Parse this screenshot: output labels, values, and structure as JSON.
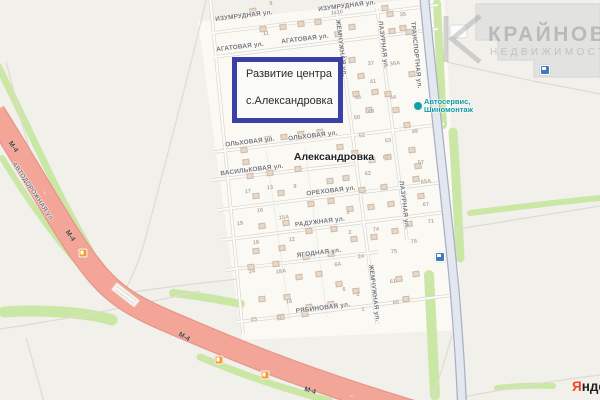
{
  "map": {
    "colors": {
      "base": "#F2F0EB",
      "village_fill": "#FAF9F4",
      "highway": "#F3A697",
      "highway_casing": "#E6968A",
      "vegetation": "#CBE7A5",
      "road_blue_fill": "#E3E7EF",
      "road_blue_casing": "#A7B1C4",
      "annotation_border": "#3B3FA6",
      "poi_teal": "#0C9CA0",
      "transit_blue": "#4079BE",
      "fuel_orange": "#F49D37",
      "yandex_red": "#FC3F1D"
    },
    "place_label": {
      "text": "Александровка",
      "x": 334,
      "y": 157
    },
    "annotation": {
      "line1": "Развитие центра",
      "line2": "с.Александровка"
    },
    "watermark": {
      "title": "КРАЙНОВ",
      "subtitle": "НЕДВИЖИМОСТЬ"
    },
    "yandex": {
      "first": "Я",
      "rest": "ндекс"
    },
    "poi_service": {
      "line1": "Автосервис,",
      "line2": "Шиномонтаж",
      "x": 424,
      "y": 106
    },
    "street_labels": [
      {
        "text": "ИЗУМРУДНАЯ ул.",
        "x": 244,
        "y": 16,
        "rot": -7
      },
      {
        "text": "ИЗУМРУДНАЯ ул.",
        "x": 347,
        "y": 6,
        "rot": -7
      },
      {
        "text": "АГАТОВАЯ ул.",
        "x": 240,
        "y": 47,
        "rot": -7
      },
      {
        "text": "АГАТОВАЯ ул.",
        "x": 305,
        "y": 39,
        "rot": -7
      },
      {
        "text": "ОЛЬХОВАЯ ул.",
        "x": 250,
        "y": 142,
        "rot": -7
      },
      {
        "text": "ОЛЬХОВАЯ ул.",
        "x": 313,
        "y": 136,
        "rot": -7
      },
      {
        "text": "ВАСИЛЬКОВАЯ ул.",
        "x": 252,
        "y": 170,
        "rot": -7
      },
      {
        "text": "ОРЕХОВАЯ ул.",
        "x": 331,
        "y": 191,
        "rot": -7
      },
      {
        "text": "РАДУЖНАЯ ул.",
        "x": 320,
        "y": 222,
        "rot": -7
      },
      {
        "text": "ЯГОДНАЯ ул.",
        "x": 319,
        "y": 253,
        "rot": -7
      },
      {
        "text": "РЯБИНОВАЯ ул.",
        "x": 323,
        "y": 308,
        "rot": -7
      },
      {
        "text": "ЖЕМЧУЖНАЯ ул.",
        "x": 341,
        "y": 48,
        "rot": 83
      },
      {
        "text": "ЖЕМЧУЖНАЯ ул.",
        "x": 374,
        "y": 293,
        "rot": 83
      },
      {
        "text": "ЛАЗУРНАЯ ул.",
        "x": 383,
        "y": 45,
        "rot": 83
      },
      {
        "text": "ЛАЗУРНАЯ ул.",
        "x": 404,
        "y": 205,
        "rot": 83
      },
      {
        "text": "ТРАНСПОРТНАЯ ул.",
        "x": 416,
        "y": 55,
        "rot": 84
      },
      {
        "text": "АВТОДОРОЖНАЯ ул.",
        "x": 33,
        "y": 192,
        "rot": 56
      }
    ],
    "highway_labels": [
      {
        "text": "М-4",
        "x": 13,
        "y": 147,
        "rot": 55
      },
      {
        "text": "М-4",
        "x": 70,
        "y": 236,
        "rot": 55
      },
      {
        "text": "М-4",
        "x": 184,
        "y": 337,
        "rot": 30
      },
      {
        "text": "М-4",
        "x": 310,
        "y": 391,
        "rot": 17
      }
    ],
    "house_numbers": [
      [
        "9",
        271,
        4
      ],
      [
        "1к10",
        337,
        13
      ],
      [
        "11",
        266,
        34
      ],
      [
        "35",
        403,
        15
      ],
      [
        "7",
        346,
        59
      ],
      [
        "37",
        371,
        64
      ],
      [
        "36А",
        395,
        64
      ],
      [
        "41",
        373,
        82
      ],
      [
        "44",
        393,
        98
      ],
      [
        "46",
        358,
        98
      ],
      [
        "49",
        371,
        112
      ],
      [
        "50",
        357,
        118
      ],
      [
        "52",
        362,
        136
      ],
      [
        "53",
        388,
        141
      ],
      [
        "57",
        386,
        158
      ],
      [
        "62",
        368,
        174
      ],
      [
        "49",
        415,
        132
      ],
      [
        "57",
        421,
        163
      ],
      [
        "65А",
        426,
        182
      ],
      [
        "67",
        426,
        205
      ],
      [
        "71",
        431,
        222
      ],
      [
        "76",
        414,
        242
      ],
      [
        "17",
        248,
        192
      ],
      [
        "13",
        270,
        188
      ],
      [
        "9",
        295,
        187
      ],
      [
        "16",
        260,
        211
      ],
      [
        "15А",
        284,
        218
      ],
      [
        "19",
        240,
        224
      ],
      [
        "18",
        256,
        243
      ],
      [
        "12",
        292,
        240
      ],
      [
        "1",
        348,
        213
      ],
      [
        "2",
        350,
        233
      ],
      [
        "74",
        376,
        230
      ],
      [
        "75",
        394,
        252
      ],
      [
        "24",
        361,
        257
      ],
      [
        "6А",
        338,
        265
      ],
      [
        "24",
        252,
        272
      ],
      [
        "18А",
        281,
        272
      ],
      [
        "6",
        344,
        290
      ],
      [
        "2",
        358,
        295
      ],
      [
        "61",
        393,
        282
      ],
      [
        "65",
        396,
        303
      ],
      [
        "18",
        289,
        302
      ],
      [
        "23",
        254,
        320
      ],
      [
        "17",
        279,
        318
      ],
      [
        "1",
        363,
        310
      ]
    ],
    "buildings": [
      [
        253,
        11
      ],
      [
        263,
        29
      ],
      [
        283,
        27
      ],
      [
        301,
        24
      ],
      [
        318,
        22
      ],
      [
        352,
        27
      ],
      [
        390,
        14
      ],
      [
        403,
        28
      ],
      [
        338,
        34
      ],
      [
        244,
        150
      ],
      [
        246,
        162
      ],
      [
        385,
        8
      ],
      [
        392,
        31
      ],
      [
        409,
        32
      ],
      [
        412,
        74
      ],
      [
        352,
        60
      ],
      [
        361,
        76
      ],
      [
        375,
        92
      ],
      [
        356,
        94
      ],
      [
        369,
        110
      ],
      [
        388,
        94
      ],
      [
        396,
        110
      ],
      [
        407,
        125
      ],
      [
        268,
        139
      ],
      [
        284,
        137
      ],
      [
        301,
        134
      ],
      [
        320,
        132
      ],
      [
        340,
        147
      ],
      [
        355,
        153
      ],
      [
        372,
        160
      ],
      [
        388,
        157
      ],
      [
        250,
        176
      ],
      [
        270,
        173
      ],
      [
        298,
        169
      ],
      [
        330,
        181
      ],
      [
        346,
        178
      ],
      [
        362,
        190
      ],
      [
        384,
        187
      ],
      [
        256,
        196
      ],
      [
        281,
        193
      ],
      [
        311,
        204
      ],
      [
        331,
        201
      ],
      [
        350,
        209
      ],
      [
        371,
        207
      ],
      [
        391,
        204
      ],
      [
        262,
        226
      ],
      [
        286,
        223
      ],
      [
        309,
        231
      ],
      [
        334,
        229
      ],
      [
        354,
        239
      ],
      [
        374,
        237
      ],
      [
        256,
        251
      ],
      [
        282,
        248
      ],
      [
        306,
        257
      ],
      [
        331,
        254
      ],
      [
        395,
        231
      ],
      [
        409,
        224
      ],
      [
        416,
        179
      ],
      [
        421,
        196
      ],
      [
        412,
        150
      ],
      [
        418,
        166
      ],
      [
        251,
        267
      ],
      [
        276,
        264
      ],
      [
        299,
        277
      ],
      [
        319,
        274
      ],
      [
        339,
        284
      ],
      [
        356,
        291
      ],
      [
        262,
        299
      ],
      [
        287,
        297
      ],
      [
        309,
        307
      ],
      [
        331,
        304
      ],
      [
        281,
        317
      ],
      [
        305,
        314
      ],
      [
        399,
        279
      ],
      [
        406,
        299
      ],
      [
        416,
        274
      ]
    ],
    "transit_stops": [
      {
        "x": 440,
        "y": 257
      },
      {
        "x": 545,
        "y": 70
      }
    ],
    "fuel_stations": [
      {
        "x": 83,
        "y": 253
      },
      {
        "x": 219,
        "y": 360
      },
      {
        "x": 265,
        "y": 375
      }
    ],
    "lane_arrows": {
      "glyph": "←",
      "points": [
        {
          "x": 45,
          "y": 193,
          "r": 58
        },
        {
          "x": 130,
          "y": 299,
          "r": 37
        },
        {
          "x": 248,
          "y": 371,
          "r": 16
        },
        {
          "x": 352,
          "y": 396,
          "r": 13
        }
      ]
    }
  }
}
